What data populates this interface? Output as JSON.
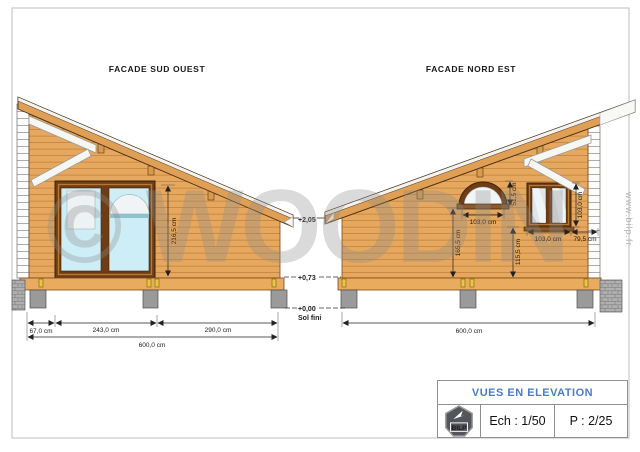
{
  "watermark": {
    "brand": "© WOODIN",
    "site": "www.bilp.fr"
  },
  "facade_sw": {
    "title": "FACADE SUD OUEST",
    "dim_height": "216,5 cm",
    "dim_left": "67,0 cm",
    "dim_window": "243,0 cm",
    "dim_right": "290,0 cm",
    "dim_total": "600,0 cm"
  },
  "facade_ne": {
    "title": "FACADE NORD EST",
    "arch_width": "103,0 cm",
    "arch_height": "51,5 cm",
    "arch_to_floor": "165,5 cm",
    "window_height": "103,0 cm",
    "window_width": "103,0 cm",
    "window_to_corner": "79,5 cm",
    "sill_to_floor": "115,5 cm",
    "dim_total": "600,0 cm"
  },
  "levels": {
    "eave": "+2,05",
    "floor": "+0,73",
    "ground": "+0,00",
    "ground_label": "Sol fini"
  },
  "title_block": {
    "title": "VUES EN ELEVATION",
    "scale": "Ech : 1/50",
    "page": "P : 2/25",
    "logo": "BILP"
  },
  "colors": {
    "wood": "#E5A85E",
    "wood_line": "#C1803A",
    "roof": "#DFA055",
    "roof_outline": "#4A3116",
    "frame_brown": "#6F3D15",
    "glass_blue": "#CDEEF6",
    "glass_gray": "#DDE6EB",
    "pier": "#9A9A9A",
    "clip_yellow": "#E8C63F",
    "accent_blue": "#4A7CC7"
  }
}
